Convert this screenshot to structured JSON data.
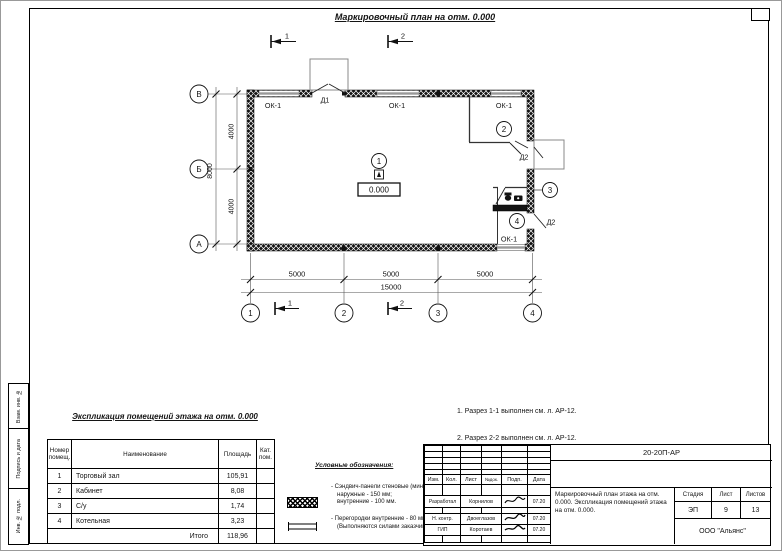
{
  "drawing": {
    "title": "Маркировочный план на отм. 0.000",
    "section_marks": [
      "1",
      "2"
    ],
    "axis_rows": [
      "В",
      "Б",
      "А"
    ],
    "axis_cols": [
      "1",
      "2",
      "3",
      "4"
    ],
    "dims": {
      "left_inner": [
        "4000",
        "4000"
      ],
      "left_outer": "8000",
      "bottom_inner": [
        "5000",
        "5000",
        "5000"
      ],
      "bottom_outer": "15000"
    },
    "labels": {
      "window": "ОК-1",
      "door_main": "Д1",
      "door_internal": "Д2",
      "elevation": "0.000"
    },
    "rooms": [
      "1",
      "2",
      "3",
      "4"
    ]
  },
  "notes": {
    "lines": [
      "1. Разрез 1-1 выполнен см. л. АР-12.",
      "2. Разрез 2-2 выполнен см. л. АР-12.",
      "3. Спецификация заполнения оконных и дверных",
      "    проемов выполнена см. л. АР-13."
    ]
  },
  "explication": {
    "title": "Экспликация помещений этажа на отм. 0.000",
    "headers": {
      "num": "Номер помещ.",
      "name": "Наименование",
      "area": "Площадь",
      "cat": "Кат. пом."
    },
    "rows": [
      {
        "num": "1",
        "name": "Торговый зал",
        "area": "105,91"
      },
      {
        "num": "2",
        "name": "Кабинет",
        "area": "8,08"
      },
      {
        "num": "3",
        "name": "С/у",
        "area": "1,74"
      },
      {
        "num": "4",
        "name": "Котельная",
        "area": "3,23"
      }
    ],
    "total_label": "Итого",
    "total_value": "118,96"
  },
  "legend": {
    "title": "Условные обозначения:",
    "item1": {
      "line1": "- Сэндвич-панели стеновые (мин. вата):",
      "line2": "наружные - 150 мм;",
      "line3": "внутренние - 100 мм."
    },
    "item2": {
      "line1": "- Перегородки внутренние - 80 мм",
      "line2": "(Выполняются силами заказчика)."
    }
  },
  "title_block": {
    "doc_number": "20-20П-АР",
    "header_cols": [
      "Изм.",
      "Кол.",
      "Лист",
      "№док.",
      "Подп.",
      "Дата"
    ],
    "staff": [
      {
        "role": "Разработал",
        "name": "Корнилов",
        "date": "07.20"
      },
      {
        "role": "Н. контр.",
        "name": "Двоеглазов",
        "date": "07.20"
      },
      {
        "role": "ГИП",
        "name": "Коротаев",
        "date": "07.20"
      }
    ],
    "sheet_title": "Маркировочный план этажа на отм. 0.000. Экспликация помещений этажа на отм. 0.000.",
    "stage_label": "Стадия",
    "stage": "ЭП",
    "sheet_label": "Лист",
    "sheet": "9",
    "sheets_label": "Листов",
    "sheets": "13",
    "company": "ООО \"Альянс\""
  },
  "side_strip": {
    "box1": "Взам. инв. №",
    "box2": "Подпись и дата",
    "box3": "Инв. № подл."
  },
  "colors": {
    "line": "#141414",
    "wall_fill": "#141414"
  }
}
